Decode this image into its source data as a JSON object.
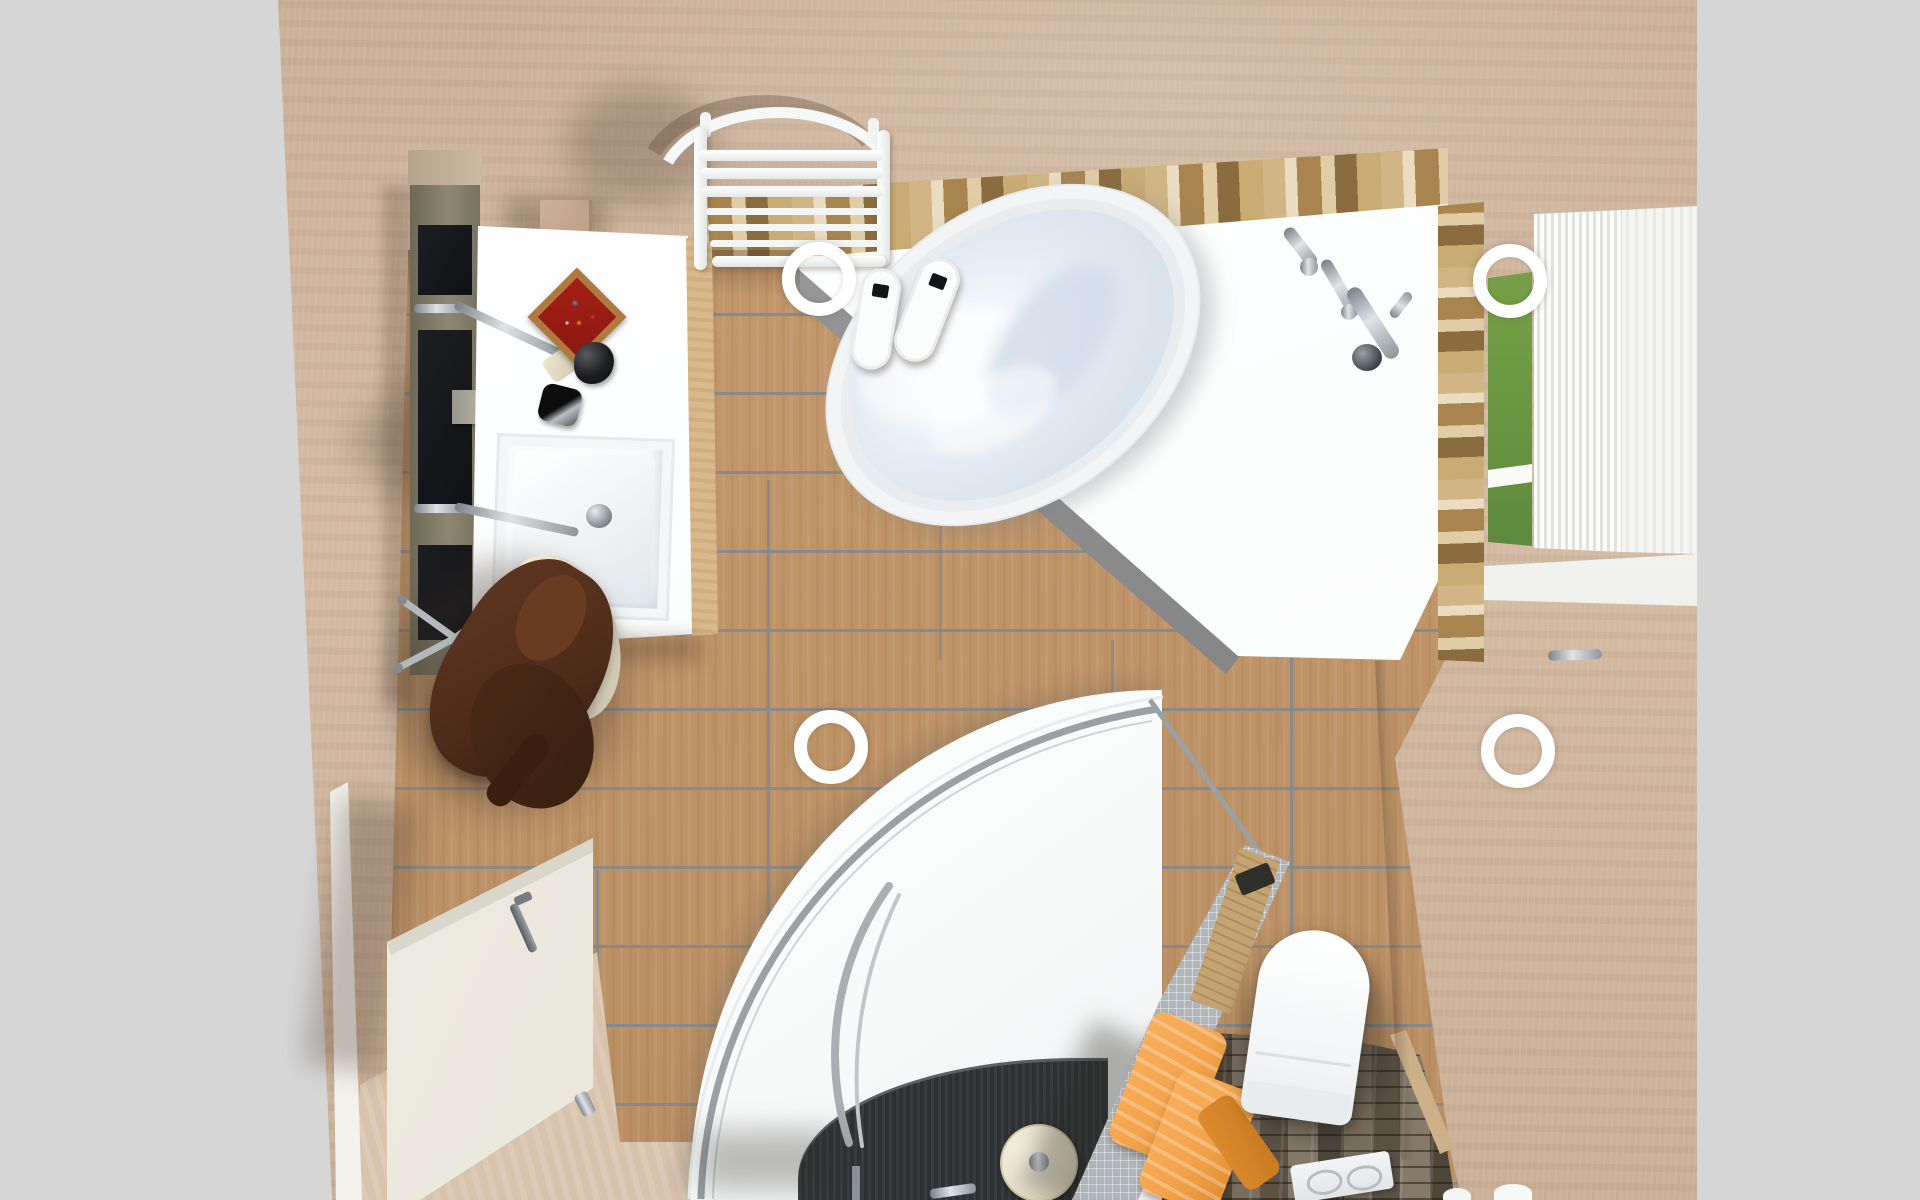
{
  "scene": {
    "type": "3d-interior-render",
    "view": "top-down-perspective",
    "room": "bathroom",
    "objects": [
      {
        "id": "background-margins",
        "label": "neutral gray canvas margins"
      },
      {
        "id": "plaster-walls",
        "label": "beige textured plaster walls seen from above"
      },
      {
        "id": "oak-floor",
        "label": "oak plank tile floor with gray grout lines"
      },
      {
        "id": "vanity-shelf-column",
        "label": "olive wall shelf column with dark niches"
      },
      {
        "id": "vanity-countertop",
        "label": "white vanity countertop"
      },
      {
        "id": "decorative-tray",
        "label": "red diamond mosaic tray"
      },
      {
        "id": "soap-dispenser",
        "label": "black soap dispenser"
      },
      {
        "id": "tumbler",
        "label": "black and chrome tumbler"
      },
      {
        "id": "washbasin",
        "label": "rectangular white washbasin with chrome faucet"
      },
      {
        "id": "towel-radiator",
        "label": "white tubular towel radiator on top wall"
      },
      {
        "id": "stone-cladding",
        "label": "stacked-stone wall band around bathtub corner"
      },
      {
        "id": "corner-bathtub",
        "label": "white corner bathtub filled with water"
      },
      {
        "id": "bath-fixtures",
        "label": "chrome bath faucet and hand shower set"
      },
      {
        "id": "slippers",
        "label": "pair of white bath slippers"
      },
      {
        "id": "spotlight-rings",
        "label": "four white ceiling spotlight rings"
      },
      {
        "id": "window",
        "label": "window with green view and open white shutter"
      },
      {
        "id": "bathrobe-stool",
        "label": "brown bathrobe draped over chrome-leg stool"
      },
      {
        "id": "entry-door",
        "label": "white entry door standing open"
      },
      {
        "id": "travertine-area",
        "label": "travertine floor patch at doorway"
      },
      {
        "id": "shower",
        "label": "curved walk-in shower with dark tray"
      },
      {
        "id": "shower-head",
        "label": "cream rain shower head"
      },
      {
        "id": "shower-rail",
        "label": "curved chrome glass-door rail"
      },
      {
        "id": "partition",
        "label": "gray mosaic partition wall with wooden cap"
      },
      {
        "id": "towels",
        "label": "orange towels hanging on partition"
      },
      {
        "id": "toilet",
        "label": "white toilet in slate-floored nook"
      },
      {
        "id": "flush-plate",
        "label": "white dual flush plate"
      },
      {
        "id": "slate-floor",
        "label": "dark slate stone floor in toilet nook"
      }
    ]
  },
  "palette": {
    "margin": "#d6d6d7",
    "wall": "#cbb098",
    "wall_hi": "#d4bba4",
    "wall_sh": "#a98e76",
    "wood": "#c49a6e",
    "wood_dark": "#b98e62",
    "grout": "#8b939b",
    "stone_a": "#d2b584",
    "stone_b": "#eadcc0",
    "stone_c": "#a8854f",
    "stone_d": "#8a6c3e",
    "white": "#fcfdfd",
    "chrome_l": "#dfe3e6",
    "chrome_d": "#7c8287",
    "water": "#e3ebf2",
    "water_hi": "#f4f8fa",
    "glass_green": "#6f9a44",
    "green_dark": "#3f6a2e",
    "slate": "#695f53",
    "slate_d": "#4a4136",
    "mosaic": "#b2b7bc",
    "mosaic_d": "#8d9296",
    "capwood": "#c8a877",
    "towel": "#f3a44c",
    "towel_d": "#de8c2d",
    "robe": "#4f2d1a",
    "robe_d": "#38200f",
    "cream": "#f4eedb",
    "door": "#f1eee3",
    "door_edge": "#d9d6ca",
    "travertine": "#dcc8b2",
    "trav_l": "#e9dac6",
    "black": "#131417",
    "tray_red": "#8d1710",
    "tray_wood": "#b07a3e",
    "shower_tray": "#2e3134"
  }
}
